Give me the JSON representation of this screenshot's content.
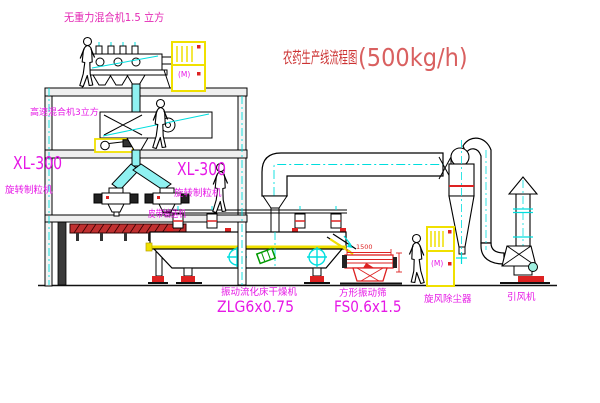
{
  "title": {
    "name": "农药生产线流程图",
    "capacity": "(500kg/h)"
  },
  "equipment_labels": {
    "top_mixer": "无重力混合机1.5 立方",
    "mid_mixer": "高速混合机3立方",
    "granulator_left_model": "XL-300",
    "granulator_left_name": "旋转制粒机",
    "granulator_right_model": "XL-300",
    "granulator_right_name": "旋转制粒机",
    "belt_conveyor": "皮带输送机",
    "dryer_name": "振动流化床干燥机",
    "dryer_model": "ZLG6x0.75",
    "sieve_name": "方形振动筛",
    "sieve_model": "FS0.6x1.5",
    "cyclone": "旋风除尘器",
    "fan": "引风机"
  },
  "annotations": {
    "sieve_width_dim": "1500",
    "motor_symbol": "(M)"
  },
  "colors": {
    "label_magenta": "#e619e6",
    "title_red": "#cc3333",
    "pipe_cyan": "#00dede",
    "cabinet_yellow": "#f0e000",
    "machine_red": "#dd2222",
    "accent_green": "#009900"
  }
}
